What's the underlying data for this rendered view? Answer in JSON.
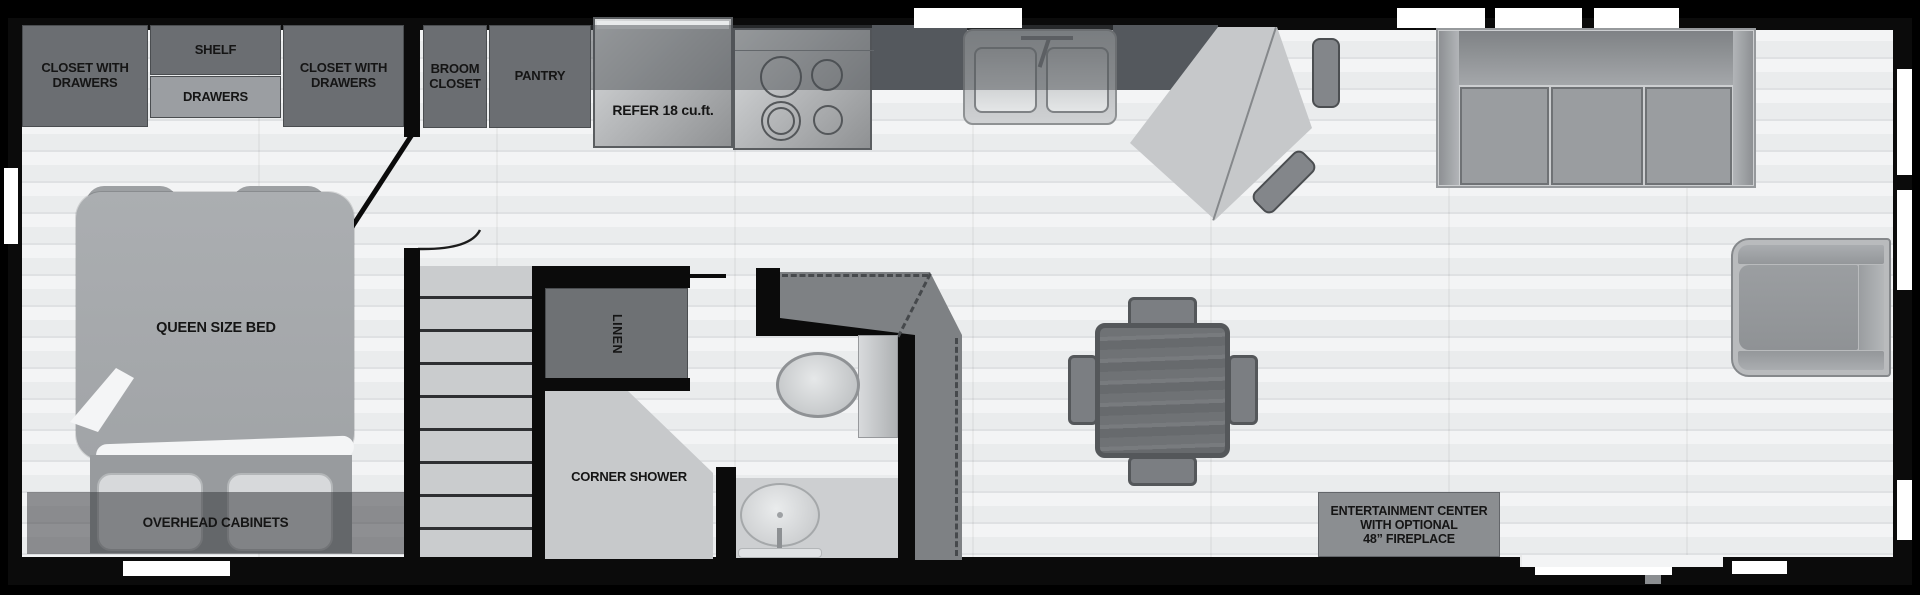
{
  "labels": {
    "closet_left": "CLOSET WITH DRAWERS",
    "shelf": "SHELF",
    "drawers": "DRAWERS",
    "closet_right": "CLOSET WITH DRAWERS",
    "broom": "BROOM CLOSET",
    "pantry": "PANTRY",
    "refer": "REFER 18 cu.ft.",
    "queen_bed": "QUEEN SIZE BED",
    "overhead": "OVERHEAD CABINETS",
    "linen": "LINEN",
    "corner_shower": "CORNER SHOWER",
    "ent_center": [
      "ENTERTAINMENT CENTER",
      "WITH OPTIONAL",
      "48” FIREPLACE"
    ]
  },
  "colors": {
    "wall": "#0b0b0b",
    "floor": "#eef0f1",
    "cabinet_dark": "#6b6e72",
    "cabinet_light": "#9b9ea2",
    "appliance_metal": "#b9bbbd",
    "furniture_gray": "#9a9da0",
    "window": "#ffffff"
  }
}
